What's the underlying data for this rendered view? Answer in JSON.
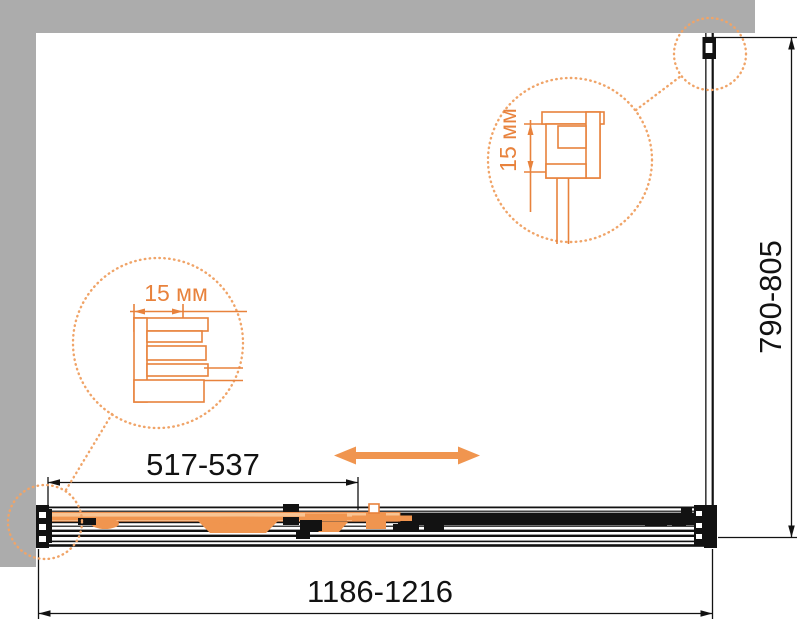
{
  "diagram": {
    "labels": {
      "door_width": "517-537",
      "overall_width": "1186-1216",
      "side_depth": "790-805",
      "detail_left": "15 мм",
      "detail_right": "15 мм"
    },
    "colors": {
      "wall_gray": "#ACACAC",
      "line_black": "#121212",
      "accent_orange": "#F0954F",
      "detail_orange": "#E8823C",
      "door_pale_orange": "#F8C493",
      "background": "#FFFFFF"
    },
    "icons": {
      "slide_direction": "double-headed-arrow"
    }
  }
}
